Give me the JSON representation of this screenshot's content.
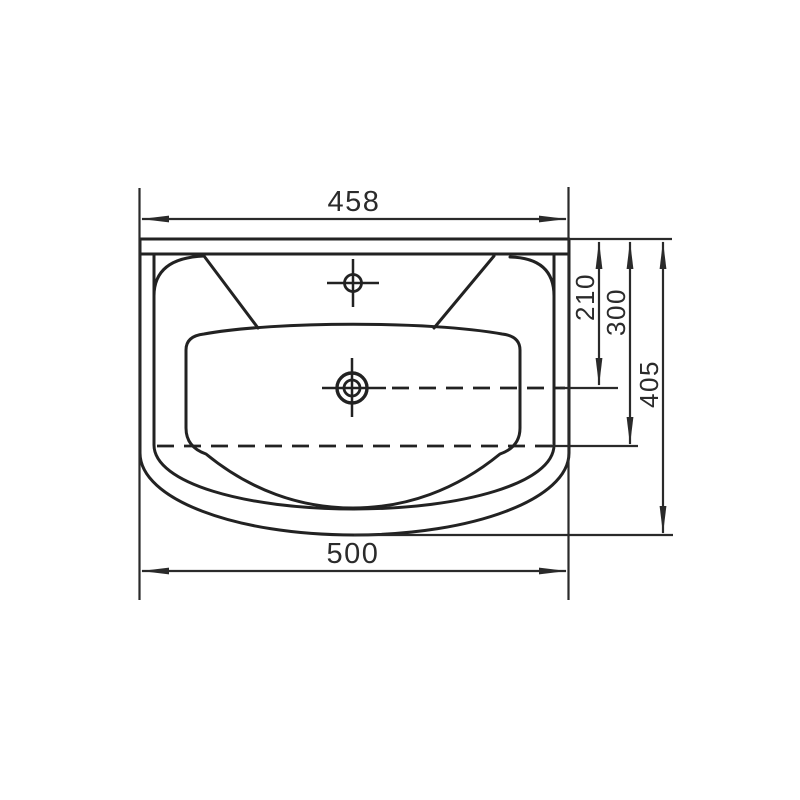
{
  "drawing": {
    "subject": "washbasin-top-view-technical-drawing",
    "colors": {
      "background": "#ffffff",
      "line": "#222222",
      "text": "#2b2b2b"
    },
    "icons": {
      "faucet_hole": "faucet-hole-icon",
      "drain_hole": "drain-hole-icon"
    },
    "dimensions": {
      "width_top": "458",
      "width_overall": "500",
      "depth_to_drain": "210",
      "depth_to_basin_front": "300",
      "depth_overall": "405"
    }
  }
}
